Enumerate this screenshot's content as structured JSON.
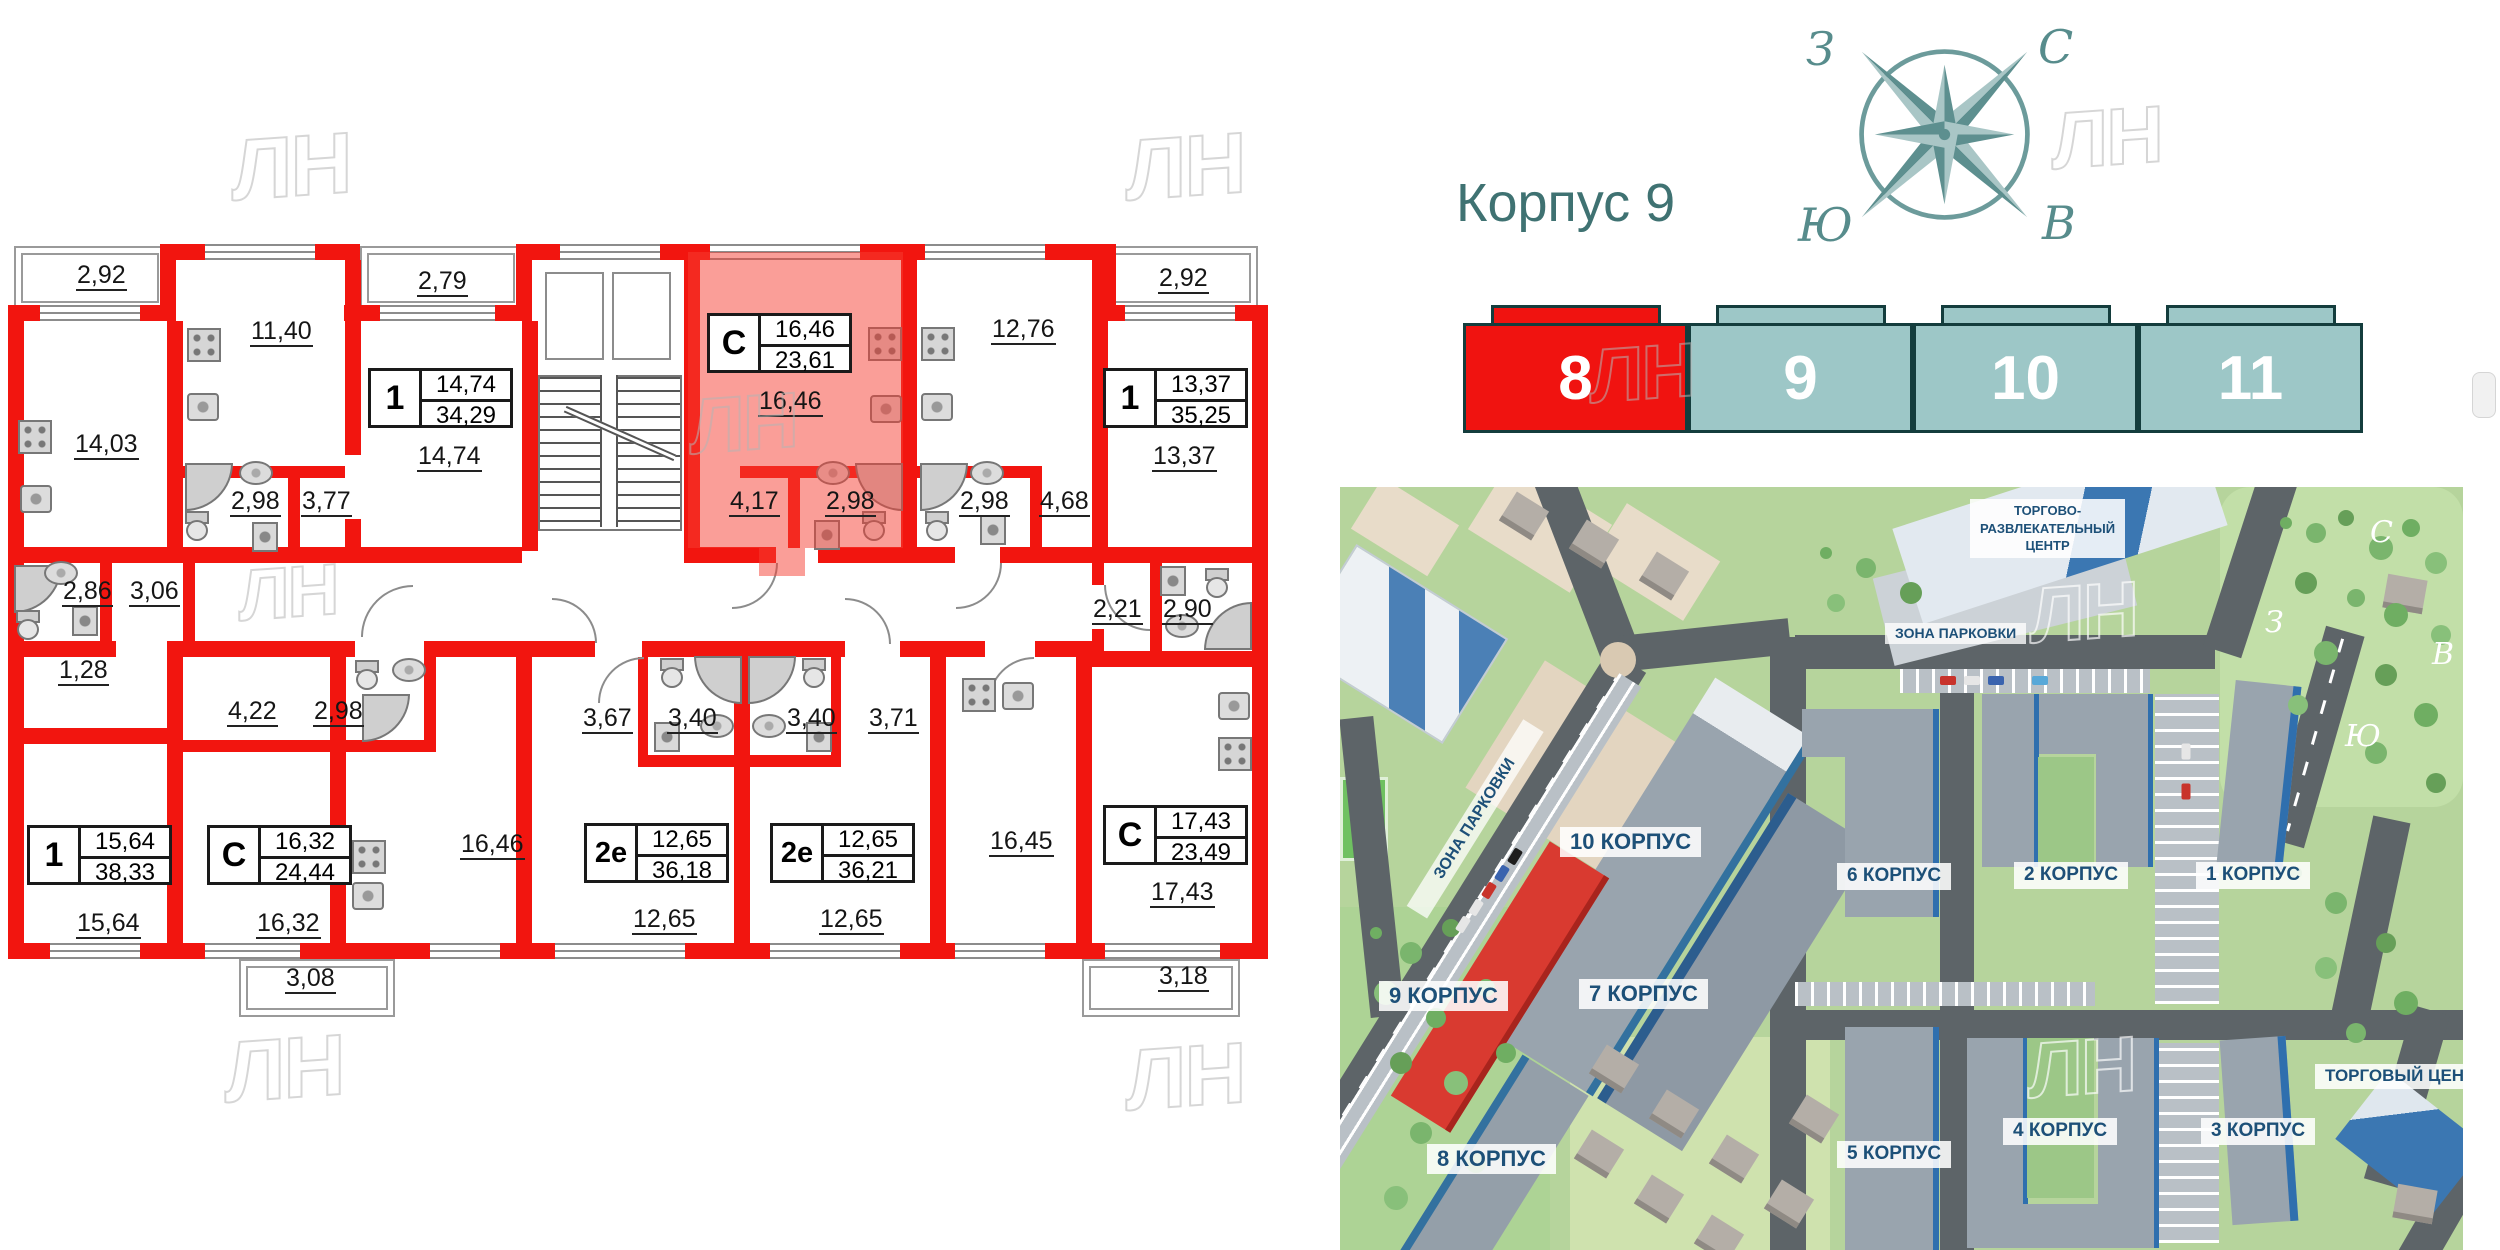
{
  "header": {
    "title": "Корпус 9"
  },
  "compass": {
    "north": "С",
    "south": "Ю",
    "west": "З",
    "east": "В"
  },
  "watermark": "ЛН",
  "building_selector": {
    "buildings": [
      {
        "label": "8",
        "state": "selected"
      },
      {
        "label": "9",
        "state": "normal"
      },
      {
        "label": "10",
        "state": "normal"
      },
      {
        "label": "11",
        "state": "normal"
      }
    ],
    "selected_color": "#f01310",
    "normal_color": "#9dc7c7"
  },
  "floorplan": {
    "wall_color": "#f2150f",
    "highlight_color": "rgba(245,62,50,0.5)",
    "highlighted_apartment": {
      "type": "С",
      "living_area": "16,46",
      "total_area": "23,61"
    },
    "badges": [
      {
        "type": "1",
        "living": "14,74",
        "total": "34,29"
      },
      {
        "type": "С",
        "living": "16,46",
        "total": "23,61"
      },
      {
        "type": "1",
        "living": "13,37",
        "total": "35,25"
      },
      {
        "type": "1",
        "living": "15,64",
        "total": "38,33"
      },
      {
        "type": "С",
        "living": "16,32",
        "total": "24,44"
      },
      {
        "type": "2е",
        "living": "12,65",
        "total": "36,18"
      },
      {
        "type": "2е",
        "living": "12,65",
        "total": "36,21"
      },
      {
        "type": "С",
        "living": "17,43",
        "total": "23,49"
      }
    ],
    "labels": [
      "2,92",
      "11,40",
      "2,79",
      "14,74",
      "14,03",
      "2,98",
      "3,77",
      "16,46",
      "4,17",
      "2,98",
      "2,98",
      "12,76",
      "4,68",
      "2,92",
      "13,37",
      "2,86",
      "3,06",
      "1,28",
      "2,21",
      "2,90",
      "4,22",
      "2,98",
      "3,67",
      "3,40",
      "3,40",
      "3,71",
      "15,64",
      "16,32",
      "16,46",
      "12,65",
      "12,65",
      "16,45",
      "17,43",
      "3,08",
      "3,18"
    ]
  },
  "map": {
    "labels": [
      "10 КОРПУС",
      "6 КОРПУС",
      "2 КОРПУС",
      "1 КОРПУС",
      "9 КОРПУС",
      "7 КОРПУС",
      "5 КОРПУС",
      "8 КОРПУС",
      "4 КОРПУС",
      "3 КОРПУС",
      "ТОРГОВЫЙ ЦЕНТР"
    ],
    "mall_lines": [
      "ТОРГОВО-",
      "РАЗВЛЕКАТЕЛЬНЫЙ",
      "ЦЕНТР"
    ],
    "parking_labels": [
      "ЗОНА ПАРКОВКИ",
      "ЗОНА ПАРКОВКИ"
    ]
  }
}
